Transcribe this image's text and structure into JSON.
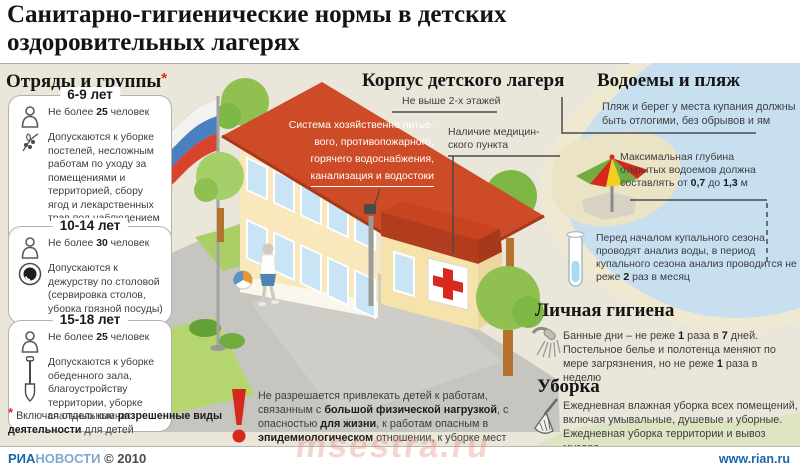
{
  "title": "Санитарно-гигиенические нормы в детских оздоровительных лагерях",
  "colors": {
    "background_beige": "#eae6da",
    "water_blue": "#c8dff0",
    "roof_red": "#ce4b27",
    "accent_red": "#d7281e",
    "link_blue": "#1a66ab",
    "grass_green": "#b5d66e"
  },
  "groups": {
    "heading": "Отряды и группы",
    "asterisk": "*",
    "items": [
      {
        "age": "6-9 лет",
        "limit": [
          {
            "t": "Не более "
          },
          {
            "t": "25",
            "b": true
          },
          {
            "t": " человек"
          }
        ],
        "task": [
          {
            "t": "Допускаются к уборке постелей, несложным работам по уходу за помещениями и территорией, сбору ягод и лекарственных трав под наблюдением воспитателя"
          }
        ]
      },
      {
        "age": "10-14 лет",
        "limit": [
          {
            "t": "Не более "
          },
          {
            "t": "30",
            "b": true
          },
          {
            "t": " человек"
          }
        ],
        "task": [
          {
            "t": "Допускаются к дежурству по столовой (сервировка столов, уборка грязной посуды)"
          }
        ]
      },
      {
        "age": "15-18 лет",
        "limit": [
          {
            "t": "Не более "
          },
          {
            "t": "25",
            "b": true
          },
          {
            "t": " человек"
          }
        ],
        "task": [
          {
            "t": "Допускаются к уборке обеденного зала, благоустройству территории, уборке спальных комнат"
          }
        ]
      }
    ],
    "footnote": [
      {
        "t": "Включая отдельные "
      },
      {
        "t": "разрешенные виды деятельности",
        "b": true
      },
      {
        "t": " для детей"
      }
    ]
  },
  "building": {
    "heading": "Корпус детского лагеря",
    "floors_note": "Не выше 2-х этажей",
    "roof_lines": [
      "Система хозяйственно питье-",
      "вого, противопожарного,",
      "горячего водоснабжения,",
      "канализация и водостоки"
    ],
    "medical_lines": [
      "Наличие медицин-",
      "ского пункта"
    ]
  },
  "water": {
    "heading": "Водоемы и пляж",
    "beach_note": "Пляж и берег у места купания должны быть отлогими, без обрывов и ям",
    "depth_note": [
      {
        "t": "Максимальная глубина открытых водоемов должна составлять от "
      },
      {
        "t": "0,7",
        "b": true
      },
      {
        "t": " до "
      },
      {
        "t": "1,3",
        "b": true
      },
      {
        "t": " м"
      }
    ],
    "analysis_note": [
      {
        "t": "Перед началом купального сезона проводят анализ воды, в период купального сезона анализ проводится не реже "
      },
      {
        "t": "2",
        "b": true
      },
      {
        "t": " раз в месяц"
      }
    ]
  },
  "hygiene": {
    "heading": "Личная гигиена",
    "text": [
      {
        "t": "Банные дни – не реже "
      },
      {
        "t": "1",
        "b": true
      },
      {
        "t": " раза в "
      },
      {
        "t": "7",
        "b": true
      },
      {
        "t": " дней. Постельное белье и полотенца меняют по мере загрязнения, но не реже "
      },
      {
        "t": "1",
        "b": true
      },
      {
        "t": " раза в неделю"
      }
    ]
  },
  "cleaning": {
    "heading": "Уборка",
    "text": [
      {
        "t": "Ежедневная влажная уборка всех помещений, включая умывальные, душевые и уборные. Ежедневная уборка территории и вывоз мусора"
      }
    ]
  },
  "warning": {
    "text": [
      {
        "t": "Не разрешается привлекать детей к работам, связанным с "
      },
      {
        "t": "большой физической нагрузкой",
        "b": true
      },
      {
        "t": ", с опасностью "
      },
      {
        "t": "для жизни",
        "b": true
      },
      {
        "t": ", к работам опасным в "
      },
      {
        "t": "эпидемиологическом",
        "b": true
      },
      {
        "t": " отношении, к уборке мест "
      },
      {
        "t": "общего пользования",
        "b": true
      }
    ]
  },
  "footer": {
    "ria": "РИА",
    "novosti": "НОВОСТИ",
    "copyright": "© 2010",
    "site": "www.rian.ru"
  },
  "watermark": "msestra.ru"
}
